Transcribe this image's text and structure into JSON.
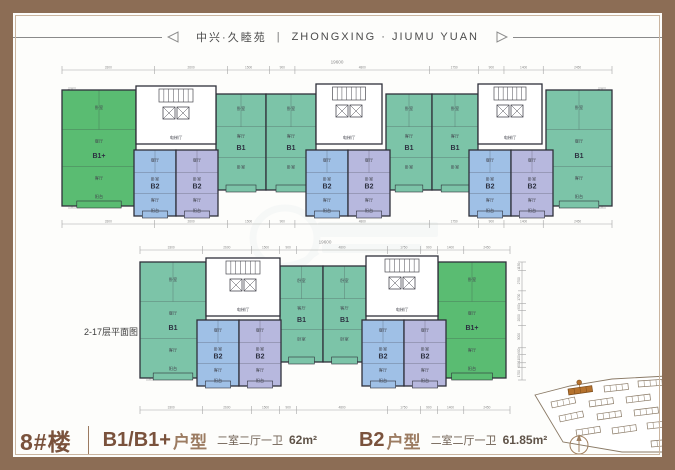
{
  "header": {
    "title_cn": "中兴·久睦苑",
    "separator": "|",
    "title_en": "ZHONGXING · JIUMU YUAN"
  },
  "floor_note": "2-17层平面图",
  "footer": {
    "building_label": "8#楼",
    "b1": {
      "name": "B1/B1+",
      "suffix": "户型",
      "desc": "二室二厅一卫",
      "area": "62m²"
    },
    "b2": {
      "name": "B2",
      "suffix": "户型",
      "desc": "二室二厅一卫",
      "area": "61.85m²"
    }
  },
  "colors": {
    "frame": "#8c6d55",
    "accent_text": "#7a523c",
    "b1": "#7cc4a8",
    "b1plus": "#5abc72",
    "b2_blue": "#9fc0e6",
    "b2_lavender": "#b7b8de",
    "wall": "#2f303a",
    "dim_line": "#a5a5a5",
    "dim_text": "#8a8a8a",
    "site_line": "#8a7a66",
    "site_highlight": "#b5722e",
    "watermark": "#c3cedd"
  },
  "core_label": "电梯厅",
  "dims": {
    "total_width": "19600",
    "total_height": "15750",
    "h_segs": [
      "3300",
      "2600",
      "1500",
      "900",
      "4800",
      "1750",
      "900",
      "1400",
      "2450"
    ],
    "v_segs": [
      "1150",
      "2700",
      "1700",
      "900",
      "2000",
      "3000",
      "900",
      "1100",
      "600",
      "1700"
    ]
  },
  "plans": {
    "top": {
      "x1": 62,
      "x2": 612,
      "y1": 88,
      "y2": 208,
      "dim_top": 70,
      "dim_bottom": 224,
      "left_col": 72,
      "right_col": 602,
      "units": [
        {
          "label": "B1+",
          "c": "b1plus",
          "x": 62,
          "y": 90,
          "w": 74,
          "h": 116,
          "rooms": [
            "卧室",
            "餐厅",
            "客厅",
            "阳台"
          ]
        },
        {
          "label": "B1",
          "c": "b1",
          "x": 216,
          "y": 94,
          "w": 50,
          "h": 96,
          "rooms": [
            "卧室",
            "客厅",
            "卧室"
          ]
        },
        {
          "label": "B1",
          "c": "b1",
          "x": 266,
          "y": 94,
          "w": 50,
          "h": 96,
          "rooms": [
            "卧室",
            "客厅",
            "卧室"
          ]
        },
        {
          "label": "B1",
          "c": "b1",
          "x": 386,
          "y": 94,
          "w": 46,
          "h": 96,
          "rooms": [
            "卧室",
            "客厅",
            "卧室"
          ]
        },
        {
          "label": "B1",
          "c": "b1",
          "x": 432,
          "y": 94,
          "w": 46,
          "h": 96,
          "rooms": [
            "卧室",
            "客厅",
            "卧室"
          ]
        },
        {
          "label": "B1",
          "c": "b1",
          "x": 546,
          "y": 90,
          "w": 66,
          "h": 116,
          "rooms": [
            "卧室",
            "餐厅",
            "客厅",
            "阳台"
          ]
        },
        {
          "label": "B2",
          "c": "b2_blue",
          "x": 134,
          "y": 150,
          "w": 42,
          "h": 66,
          "rooms": [
            "餐厅",
            "卧室",
            "客厅",
            "阳台"
          ]
        },
        {
          "label": "B2",
          "c": "b2_lavender",
          "x": 176,
          "y": 150,
          "w": 42,
          "h": 66,
          "rooms": [
            "餐厅",
            "卧室",
            "客厅",
            "阳台"
          ]
        },
        {
          "label": "B2",
          "c": "b2_blue",
          "x": 306,
          "y": 150,
          "w": 42,
          "h": 66,
          "rooms": [
            "餐厅",
            "卧室",
            "客厅",
            "阳台"
          ]
        },
        {
          "label": "B2",
          "c": "b2_lavender",
          "x": 348,
          "y": 150,
          "w": 42,
          "h": 66,
          "rooms": [
            "餐厅",
            "卧室",
            "客厅",
            "阳台"
          ]
        },
        {
          "label": "B2",
          "c": "b2_blue",
          "x": 469,
          "y": 150,
          "w": 42,
          "h": 66,
          "rooms": [
            "餐厅",
            "卧室",
            "客厅",
            "阳台"
          ]
        },
        {
          "label": "B2",
          "c": "b2_lavender",
          "x": 511,
          "y": 150,
          "w": 42,
          "h": 66,
          "rooms": [
            "餐厅",
            "卧室",
            "客厅",
            "阳台"
          ]
        }
      ],
      "cores": [
        {
          "x": 136,
          "y": 86,
          "w": 80,
          "h": 58
        },
        {
          "x": 316,
          "y": 84,
          "w": 66,
          "h": 60
        },
        {
          "x": 478,
          "y": 84,
          "w": 64,
          "h": 60
        }
      ]
    },
    "bottom": {
      "x1": 140,
      "x2": 510,
      "y1": 262,
      "y2": 380,
      "dim_top": 250,
      "dim_bottom": 410,
      "left_col": 150,
      "right_col": 522,
      "units": [
        {
          "label": "B1",
          "c": "b1",
          "x": 140,
          "y": 262,
          "w": 66,
          "h": 116,
          "rooms": [
            "卧室",
            "餐厅",
            "客厅",
            "阳台"
          ]
        },
        {
          "label": "B1",
          "c": "b1",
          "x": 280,
          "y": 266,
          "w": 43,
          "h": 96,
          "rooms": [
            "卧室",
            "客厅",
            "卧室"
          ]
        },
        {
          "label": "B1",
          "c": "b1",
          "x": 323,
          "y": 266,
          "w": 43,
          "h": 96,
          "rooms": [
            "卧室",
            "客厅",
            "卧室"
          ]
        },
        {
          "label": "B1+",
          "c": "b1plus",
          "x": 438,
          "y": 262,
          "w": 68,
          "h": 116,
          "rooms": [
            "卧室",
            "餐厅",
            "客厅",
            "阳台"
          ]
        },
        {
          "label": "B2",
          "c": "b2_blue",
          "x": 197,
          "y": 320,
          "w": 42,
          "h": 66,
          "rooms": [
            "餐厅",
            "卧室",
            "客厅",
            "阳台"
          ]
        },
        {
          "label": "B2",
          "c": "b2_lavender",
          "x": 239,
          "y": 320,
          "w": 42,
          "h": 66,
          "rooms": [
            "餐厅",
            "卧室",
            "客厅",
            "阳台"
          ]
        },
        {
          "label": "B2",
          "c": "b2_blue",
          "x": 362,
          "y": 320,
          "w": 42,
          "h": 66,
          "rooms": [
            "餐厅",
            "卧室",
            "客厅",
            "阳台"
          ]
        },
        {
          "label": "B2",
          "c": "b2_lavender",
          "x": 404,
          "y": 320,
          "w": 42,
          "h": 66,
          "rooms": [
            "餐厅",
            "卧室",
            "客厅",
            "阳台"
          ]
        }
      ],
      "cores": [
        {
          "x": 206,
          "y": 258,
          "w": 74,
          "h": 58
        },
        {
          "x": 366,
          "y": 256,
          "w": 72,
          "h": 60
        }
      ]
    }
  },
  "site_map": {
    "outline": "535,395 570,386 612,379 667,376 667,452 622,452 563,442",
    "buildings": [
      {
        "x": 568,
        "y": 389,
        "r": -8,
        "highlight": true
      },
      {
        "x": 604,
        "y": 386,
        "r": -6,
        "highlight": false
      },
      {
        "x": 638,
        "y": 381,
        "r": -4,
        "highlight": false
      },
      {
        "x": 551,
        "y": 402,
        "r": -12,
        "highlight": false
      },
      {
        "x": 589,
        "y": 401,
        "r": -8,
        "highlight": false
      },
      {
        "x": 626,
        "y": 397,
        "r": -7,
        "highlight": false
      },
      {
        "x": 559,
        "y": 416,
        "r": -12,
        "highlight": false
      },
      {
        "x": 597,
        "y": 414,
        "r": -8,
        "highlight": false
      },
      {
        "x": 634,
        "y": 410,
        "r": -7,
        "highlight": false
      },
      {
        "x": 576,
        "y": 430,
        "r": -9,
        "highlight": false
      },
      {
        "x": 612,
        "y": 428,
        "r": -8,
        "highlight": false
      },
      {
        "x": 647,
        "y": 423,
        "r": -6,
        "highlight": false
      },
      {
        "x": 651,
        "y": 441,
        "r": -5,
        "highlight": false
      }
    ]
  },
  "compass": {
    "cx": 579,
    "cy": 445,
    "r": 9
  }
}
